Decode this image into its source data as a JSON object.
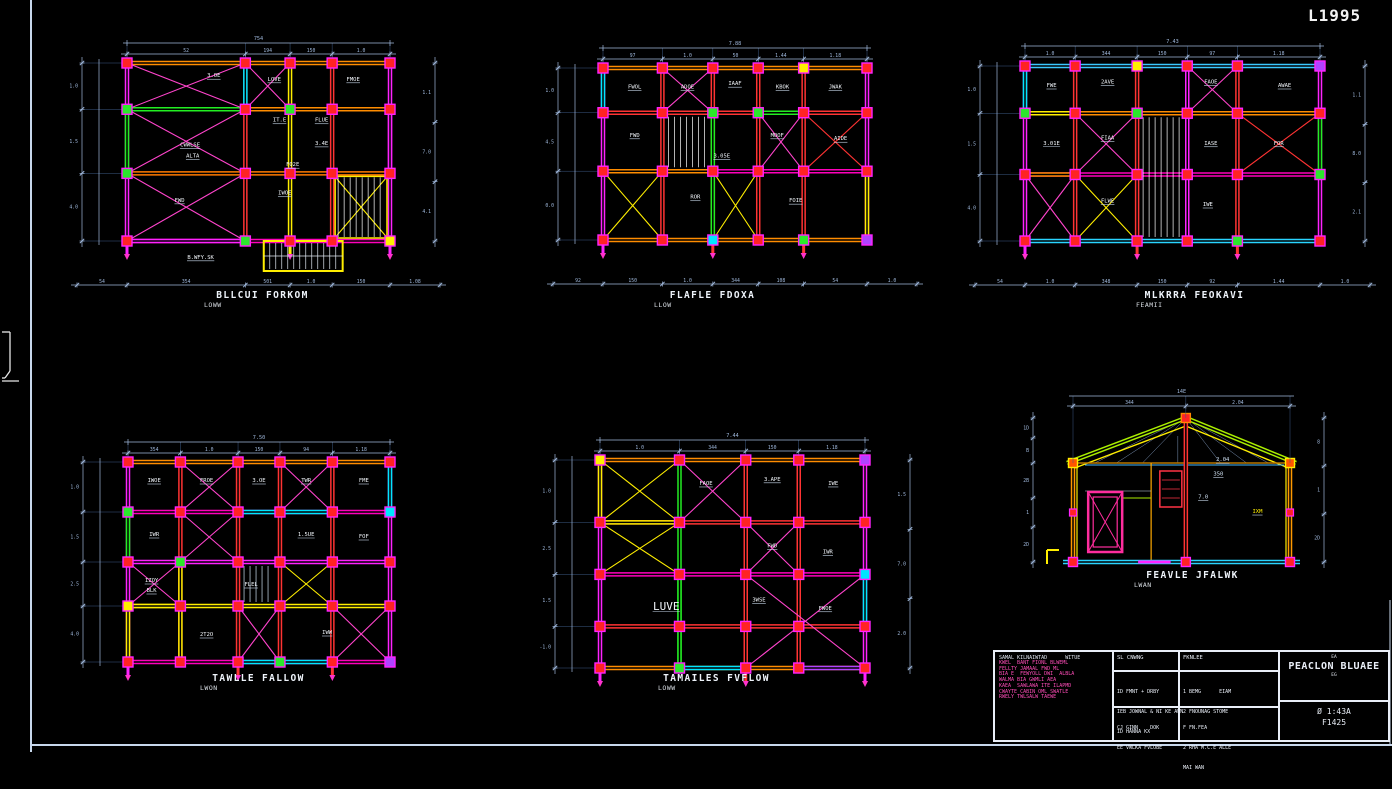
{
  "sheet": {
    "code": "L1995"
  },
  "colors": {
    "background": "#000000",
    "frame": "#c8d8ec",
    "dimension": "#9fb8dc",
    "column_fill": "#ff2323",
    "column_stroke": "#ff22ff",
    "beam_orange": "#ff8c00",
    "beam_red": "#ff3333",
    "beam_magenta": "#ff00bb",
    "accent_green": "#22ee22",
    "accent_yellow": "#ffee00",
    "accent_cyan": "#00e5ff",
    "label_text": "#f2f6fb",
    "notes_pink": "#ff4db8"
  },
  "plans": [
    {
      "cap1": "BLLCUI FORKOM",
      "cap2": "LOWW",
      "x": 127,
      "y": 63,
      "w": 263,
      "h": 178,
      "cols": [
        0,
        0.45,
        0.62,
        0.78,
        1
      ],
      "rows": [
        0,
        0.26,
        0.62,
        1
      ],
      "hc": [
        "#ff8c00",
        "#ff8c00",
        "#ff7a00",
        "#ff00bb"
      ],
      "vc": [
        "#ff22ff",
        "#ff3333",
        "#ffee00",
        "#ff3333",
        "#ff22ff"
      ],
      "segs": [
        {
          "o": "v",
          "i": 0,
          "a": 1,
          "b": 2,
          "c": "#22ee22"
        },
        {
          "o": "h",
          "i": 1,
          "a": 0,
          "b": 1,
          "c": "#22ee22"
        },
        {
          "o": "h",
          "i": 3,
          "a": 0,
          "b": 1,
          "c": "#ff22ff"
        },
        {
          "o": "v",
          "i": 1,
          "a": 0,
          "b": 1,
          "c": "#00e5ff"
        },
        {
          "o": "v",
          "i": 4,
          "a": 1,
          "b": 2,
          "c": "#ff22ff"
        }
      ],
      "braces": [
        {
          "c0": 0,
          "r0": 0,
          "c1": 1,
          "r1": 1,
          "col": "#ff44cc"
        },
        {
          "c0": 0,
          "r0": 1,
          "c1": 1,
          "r1": 2,
          "col": "#ff44cc"
        },
        {
          "c0": 0,
          "r0": 2,
          "c1": 1,
          "r1": 3,
          "col": "#ff44cc"
        },
        {
          "c0": 1,
          "r0": 0,
          "c1": 2,
          "r1": 1,
          "col": "#ff44cc"
        },
        {
          "c0": 3,
          "r0": 2,
          "c1": 4,
          "r1": 3,
          "col": "#ffee00"
        }
      ],
      "stairs": [
        {
          "c0": 3,
          "r0": 2,
          "c1": 4,
          "r1": 3,
          "col": "#ffffff",
          "box": "#ffee00"
        }
      ],
      "ovr": [
        [
          0,
          1,
          "#2be82b"
        ],
        [
          0,
          2,
          "#2be82b"
        ],
        [
          2,
          1,
          "#2be82b"
        ],
        [
          1,
          3,
          "#2be82b"
        ],
        [
          4,
          3,
          "#ffee00"
        ]
      ],
      "labels": [
        [
          "LOVE",
          0.56,
          0.1
        ],
        [
          "FMOE",
          0.86,
          0.1
        ],
        [
          "3.OE",
          0.33,
          0.08
        ],
        [
          "IT.E",
          0.58,
          0.33
        ],
        [
          "FLUE",
          0.74,
          0.33
        ],
        [
          "CWWLSE",
          0.24,
          0.47
        ],
        [
          "ALTA",
          0.25,
          0.53
        ],
        [
          "3.4E",
          0.74,
          0.46
        ],
        [
          "FO2E",
          0.63,
          0.58
        ],
        [
          "IWOE",
          0.6,
          0.74
        ],
        [
          "FWD",
          0.2,
          0.78
        ],
        [
          "B.WFY.SK",
          0.28,
          1.1
        ]
      ],
      "annex": {
        "x0": 0.52,
        "x1": 0.82,
        "h": 30,
        "col": "#ffee00",
        "hatch": true
      },
      "tails": true,
      "total": "754",
      "dt": [
        "52",
        "194",
        "150",
        "1.0"
      ],
      "dl": [
        "1.0",
        "1.5",
        "4.0"
      ],
      "db": [
        "54",
        "354",
        "501",
        "1.0",
        "150",
        "1.08"
      ],
      "dr": [
        "1.1",
        "7.0",
        "4.1"
      ]
    },
    {
      "cap1": "FLAFLE FDOXA",
      "cap2": "LLOW",
      "x": 603,
      "y": 68,
      "w": 264,
      "h": 172,
      "cols": [
        0,
        0.225,
        0.416,
        0.588,
        0.76,
        1
      ],
      "rows": [
        0,
        0.26,
        0.6,
        1
      ],
      "hc": [
        "#ff8c00",
        "#ff3333",
        "#ff00bb",
        "#ff8c00"
      ],
      "vc": [
        "#ff22ff",
        "#ff3333",
        "#ff3333",
        "#ff3333",
        "#ff3333",
        "#ff22ff"
      ],
      "segs": [
        {
          "o": "v",
          "i": 0,
          "a": 0,
          "b": 1,
          "c": "#00e5ff"
        },
        {
          "o": "h",
          "i": 1,
          "a": 3,
          "b": 4,
          "c": "#22ee22"
        },
        {
          "o": "v",
          "i": 2,
          "a": 1,
          "b": 3,
          "c": "#22ee22"
        },
        {
          "o": "v",
          "i": 5,
          "a": 2,
          "b": 3,
          "c": "#ffee00"
        },
        {
          "o": "h",
          "i": 2,
          "a": 0,
          "b": 2,
          "c": "#ff8c00"
        }
      ],
      "braces": [
        {
          "c0": 4,
          "r0": 1,
          "c1": 5,
          "r1": 2,
          "col": "#ff3333"
        },
        {
          "c0": 0,
          "r0": 2,
          "c1": 1,
          "r1": 3,
          "col": "#ffee00"
        },
        {
          "c0": 2,
          "r0": 2,
          "c1": 3,
          "r1": 3,
          "col": "#ffee00"
        },
        {
          "c0": 1,
          "r0": 0,
          "c1": 2,
          "r1": 1,
          "col": "#ff44cc"
        },
        {
          "c0": 3,
          "r0": 1,
          "c1": 4,
          "r1": 2,
          "col": "#ff44cc"
        }
      ],
      "stairs": [
        {
          "c0": 1,
          "r0": 1,
          "c1": 2,
          "r1": 2,
          "col": "#ffffff"
        }
      ],
      "ovr": [
        [
          2,
          1,
          "#2be82b"
        ],
        [
          3,
          1,
          "#2be82b"
        ],
        [
          4,
          0,
          "#ffee00"
        ],
        [
          4,
          3,
          "#2be82b"
        ],
        [
          5,
          3,
          "#b043ff"
        ],
        [
          2,
          3,
          "#00e5ff"
        ]
      ],
      "labels": [
        [
          "FWOL",
          0.12,
          0.12
        ],
        [
          "ADOE",
          0.32,
          0.12
        ],
        [
          "IAAF",
          0.5,
          0.1
        ],
        [
          "KBOK",
          0.68,
          0.12
        ],
        [
          "JWAK",
          0.88,
          0.12
        ],
        [
          "FWD",
          0.12,
          0.4
        ],
        [
          "MOOF",
          0.66,
          0.4
        ],
        [
          "AIDE",
          0.9,
          0.42
        ],
        [
          "3.05E",
          0.45,
          0.52
        ],
        [
          "ROR",
          0.35,
          0.76
        ],
        [
          "FOIE",
          0.73,
          0.78
        ]
      ],
      "tails": true,
      "total": "7.88",
      "dt": [
        "97",
        "1.0",
        "50",
        "1.44",
        "1.18"
      ],
      "dl": [
        "1.0",
        "4.5",
        "0.0"
      ],
      "db": [
        "92",
        "150",
        "1.0",
        "344",
        "108",
        "54",
        "1.0"
      ]
    },
    {
      "cap1": "MLKRRA FEOKAVI",
      "cap2": "FEAMII",
      "x": 1025,
      "y": 66,
      "w": 295,
      "h": 175,
      "cols": [
        0,
        0.17,
        0.38,
        0.55,
        0.72,
        1
      ],
      "rows": [
        0,
        0.27,
        0.62,
        1
      ],
      "hc": [
        "#3ac8ff",
        "#ff8c00",
        "#ff00bb",
        "#2ad4ff"
      ],
      "vc": [
        "#ff22ff",
        "#ff3333",
        "#ff3333",
        "#ff22ff",
        "#ff3333",
        "#ff22ff"
      ],
      "segs": [
        {
          "o": "v",
          "i": 0,
          "a": 0,
          "b": 1,
          "c": "#00e5ff"
        },
        {
          "o": "v",
          "i": 5,
          "a": 1,
          "b": 2,
          "c": "#22ee22"
        },
        {
          "o": "h",
          "i": 1,
          "a": 0,
          "b": 1,
          "c": "#ffee00"
        },
        {
          "o": "v",
          "i": 3,
          "a": 1,
          "b": 3,
          "c": "#ff22ff"
        },
        {
          "o": "h",
          "i": 2,
          "a": 0,
          "b": 1,
          "c": "#ff8c00"
        },
        {
          "o": "h",
          "i": 1,
          "a": 3,
          "b": 5,
          "c": "#ff8c00"
        }
      ],
      "braces": [
        {
          "c0": 3,
          "r0": 0,
          "c1": 4,
          "r1": 1,
          "col": "#ff44cc"
        },
        {
          "c0": 4,
          "r0": 1,
          "c1": 5,
          "r1": 2,
          "col": "#ff3333"
        },
        {
          "c0": 1,
          "r0": 1,
          "c1": 2,
          "r1": 2,
          "col": "#ff44cc"
        },
        {
          "c0": 0,
          "r0": 2,
          "c1": 1,
          "r1": 3,
          "col": "#ff44cc"
        },
        {
          "c0": 1,
          "r0": 2,
          "c1": 2,
          "r1": 3,
          "col": "#ffee00"
        }
      ],
      "stairs": [
        {
          "c0": 2,
          "r0": 1,
          "c1": 3,
          "r1": 3,
          "col": "#ffffff"
        }
      ],
      "ovr": [
        [
          0,
          1,
          "#2be82b"
        ],
        [
          5,
          2,
          "#2be82b"
        ],
        [
          2,
          0,
          "#ffee00"
        ],
        [
          5,
          0,
          "#b043ff"
        ],
        [
          2,
          1,
          "#2be82b"
        ],
        [
          4,
          3,
          "#2be82b"
        ]
      ],
      "labels": [
        [
          "FWE",
          0.09,
          0.12
        ],
        [
          "2AVE",
          0.28,
          0.1
        ],
        [
          "FAOE",
          0.63,
          0.1
        ],
        [
          "AWAE",
          0.88,
          0.12
        ],
        [
          "3.01E",
          0.09,
          0.45
        ],
        [
          "FIAA",
          0.28,
          0.42
        ],
        [
          "IASE",
          0.63,
          0.45
        ],
        [
          "FOR",
          0.86,
          0.45
        ],
        [
          "FLWE",
          0.28,
          0.78
        ],
        [
          "IWE",
          0.62,
          0.8
        ]
      ],
      "tails": true,
      "total": "7.43",
      "dt": [
        "1.0",
        "344",
        "150",
        "97",
        "1.18"
      ],
      "dl": [
        "1.0",
        "1.5",
        "4.0"
      ],
      "db": [
        "54",
        "1.0",
        "348",
        "150",
        "92",
        "1.44",
        "1.0"
      ],
      "dr": [
        "1.1",
        "8.0",
        "2.1"
      ]
    },
    {
      "cap1": "TAWLLE FALLOW",
      "cap2": "LWON",
      "x": 128,
      "y": 462,
      "w": 262,
      "h": 200,
      "cols": [
        0,
        0.2,
        0.42,
        0.58,
        0.78,
        1
      ],
      "rows": [
        0,
        0.25,
        0.5,
        0.72,
        1
      ],
      "hc": [
        "#ff8c00",
        "#ff00bb",
        "#ff22ff",
        "#ffee00",
        "#ff00bb"
      ],
      "vc": [
        "#ff22ff",
        "#ff3333",
        "#ff3333",
        "#ff3333",
        "#ff3333",
        "#ff22ff"
      ],
      "segs": [
        {
          "o": "v",
          "i": 0,
          "a": 1,
          "b": 2,
          "c": "#22ee22"
        },
        {
          "o": "h",
          "i": 1,
          "a": 2,
          "b": 4,
          "c": "#00e5ff"
        },
        {
          "o": "v",
          "i": 5,
          "a": 0,
          "b": 1,
          "c": "#00e5ff"
        },
        {
          "o": "h",
          "i": 3,
          "a": 0,
          "b": 1,
          "c": "#ffee00"
        },
        {
          "o": "v",
          "i": 1,
          "a": 2,
          "b": 4,
          "c": "#ffee00"
        },
        {
          "o": "h",
          "i": 4,
          "a": 2,
          "b": 4,
          "c": "#00e5ff"
        },
        {
          "o": "v",
          "i": 0,
          "a": 3,
          "b": 4,
          "c": "#ffee00"
        }
      ],
      "braces": [
        {
          "c0": 1,
          "r0": 0,
          "c1": 2,
          "r1": 1,
          "col": "#ff44cc"
        },
        {
          "c0": 3,
          "r0": 0,
          "c1": 4,
          "r1": 1,
          "col": "#ff44cc"
        },
        {
          "c0": 1,
          "r0": 1,
          "c1": 2,
          "r1": 2,
          "col": "#ff44cc"
        },
        {
          "c0": 3,
          "r0": 2,
          "c1": 4,
          "r1": 3,
          "col": "#ffee00"
        },
        {
          "c0": 2,
          "r0": 3,
          "c1": 3,
          "r1": 4,
          "col": "#ff44cc"
        },
        {
          "c0": 0,
          "r0": 2,
          "c1": 1,
          "r1": 3,
          "col": "#ff44cc"
        },
        {
          "c0": 4,
          "r0": 3,
          "c1": 5,
          "r1": 4,
          "col": "#ff44cc"
        }
      ],
      "stairs": [
        {
          "c0": 2,
          "r0": 2,
          "c1": 3,
          "r1": 3,
          "col": "#cfe0f2"
        }
      ],
      "ovr": [
        [
          0,
          1,
          "#2be82b"
        ],
        [
          0,
          3,
          "#ffee00"
        ],
        [
          5,
          1,
          "#00e5ff"
        ],
        [
          3,
          4,
          "#2be82b"
        ],
        [
          5,
          4,
          "#b043ff"
        ],
        [
          1,
          2,
          "#2be82b"
        ]
      ],
      "labels": [
        [
          "IWOE",
          0.1,
          0.1
        ],
        [
          "FROE",
          0.3,
          0.1
        ],
        [
          "3.OE",
          0.5,
          0.1
        ],
        [
          "TWR",
          0.68,
          0.1
        ],
        [
          "FME",
          0.9,
          0.1
        ],
        [
          "IWR",
          0.1,
          0.37
        ],
        [
          "1.5UE",
          0.68,
          0.37
        ],
        [
          "FOF",
          0.9,
          0.38
        ],
        [
          "IZOY",
          0.09,
          0.6
        ],
        [
          "BLK",
          0.09,
          0.65
        ],
        [
          "FLEL",
          0.47,
          0.62
        ],
        [
          "2T2O",
          0.3,
          0.87
        ],
        [
          "IWW",
          0.76,
          0.86
        ]
      ],
      "tails": true,
      "total": "7.50",
      "dt": [
        "354",
        "1.0",
        "150",
        "94",
        "1.18"
      ],
      "dl": [
        "1.0",
        "1.5",
        "2.5",
        "4.0"
      ]
    },
    {
      "cap1": "TAMAILES FVFLOW",
      "cap2": "LOWW",
      "x": 600,
      "y": 460,
      "w": 265,
      "h": 208,
      "cols": [
        0,
        0.3,
        0.55,
        0.75,
        1
      ],
      "rows": [
        0,
        0.3,
        0.55,
        0.8,
        1
      ],
      "hc": [
        "#ff8c00",
        "#ff3333",
        "#ff00bb",
        "#ff3333",
        "#ff8c00"
      ],
      "vc": [
        "#ff22ff",
        "#22ee22",
        "#ff3333",
        "#ff3333",
        "#ff22ff"
      ],
      "segs": [
        {
          "o": "v",
          "i": 0,
          "a": 0,
          "b": 1,
          "c": "#ffee00"
        },
        {
          "o": "h",
          "i": 1,
          "a": 0,
          "b": 1,
          "c": "#ffee00"
        },
        {
          "o": "v",
          "i": 4,
          "a": 2,
          "b": 3,
          "c": "#00e5ff"
        },
        {
          "o": "h",
          "i": 4,
          "a": 1,
          "b": 2,
          "c": "#00e5ff"
        },
        {
          "o": "v",
          "i": 1,
          "a": 2,
          "b": 4,
          "c": "#22ee22"
        },
        {
          "o": "h",
          "i": 4,
          "a": 3,
          "b": 4,
          "c": "#b043ff"
        }
      ],
      "braces": [
        {
          "c0": 0,
          "r0": 0,
          "c1": 1,
          "r1": 1,
          "col": "#ffee00"
        },
        {
          "c0": 0,
          "r0": 1,
          "c1": 1,
          "r1": 2,
          "col": "#ffee00"
        },
        {
          "c0": 2,
          "r0": 1,
          "c1": 3,
          "r1": 2,
          "col": "#ff44cc"
        },
        {
          "c0": 2,
          "r0": 2,
          "c1": 4,
          "r1": 4,
          "col": "#ff44cc"
        },
        {
          "c0": 1,
          "r0": 0,
          "c1": 2,
          "r1": 1,
          "col": "#ff44cc"
        }
      ],
      "ovr": [
        [
          0,
          0,
          "#ffee00"
        ],
        [
          4,
          2,
          "#00e5ff"
        ],
        [
          1,
          4,
          "#2be82b"
        ],
        [
          4,
          0,
          "#b043ff"
        ]
      ],
      "labels": [
        [
          "FAOE",
          0.4,
          0.12
        ],
        [
          "3.APE",
          0.65,
          0.1
        ],
        [
          "IWE",
          0.88,
          0.12
        ],
        [
          "FWD",
          0.65,
          0.42
        ],
        [
          "IWR",
          0.86,
          0.45
        ],
        [
          "LUVE",
          0.25,
          0.72,
          "big"
        ],
        [
          "3WSE",
          0.6,
          0.68
        ],
        [
          "FWOE",
          0.85,
          0.72
        ]
      ],
      "tails": true,
      "total": "7.44",
      "dt": [
        "1.0",
        "344",
        "150",
        "1.18"
      ],
      "dl": [
        "1.0",
        "2.5",
        "1.5",
        "-1.0"
      ],
      "dr": [
        "1.5",
        "7.0",
        "2.0"
      ]
    },
    {
      "type": "sec",
      "cap1": "FEAVLE JFALWK",
      "cap2": "LWAN",
      "x": 1073,
      "y": 418,
      "w": 217,
      "h": 144,
      "eave": 45,
      "total": "14E",
      "dt": [
        "344",
        "2.04"
      ],
      "dl": [
        "1D",
        "B",
        "2B",
        "1",
        "2D"
      ],
      "dr": [
        "8",
        "1",
        "2D"
      ],
      "labels": [
        [
          "2.04",
          0.69,
          0.3
        ],
        [
          "350",
          0.67,
          0.4
        ],
        [
          "7.0",
          0.6,
          0.56
        ],
        [
          "IXM",
          0.85,
          0.66,
          "y"
        ]
      ]
    }
  ],
  "title_block": {
    "notes_header": "SAMAL KILNAIWTAD      WITUE",
    "notes": [
      "KWEL  BANT FIONL BLWEML",
      "FELLTY JAMAAL FWD ML",
      "BIA E  FEWYOLL DWI  ALBLA",
      "WALMA BIA GWMLI AEA",
      "KAEA  SAWLAWA ITE ILAPMD",
      "CWAYTE CABIN OML SWATLE",
      "RWELY TWLSALW TAEWE"
    ],
    "col2_header": "SL CNWNG",
    "col2_rows1": [
      "ID FMNT + DRBY",
      "IEB JOWNAL & NI KE AWN",
      "ID HANNA KX"
    ],
    "col2_rows2": [
      "CJ GINN    DOK",
      "EE VWLKA FVLOBE"
    ],
    "col3_header": "FKNLEE",
    "col3_rows1": [
      "1 BEMG      EIAM",
      "2 FNOUNAG STOME"
    ],
    "col3_rows2": [
      "F FN.FEA",
      "2 RHA M.C.E ALLE",
      "MAI WAN"
    ],
    "right_small_top": "EA",
    "right_title": "PEACLON BLUAEE",
    "right_small_sub": "EG",
    "right_scale": "Ø 1:43A",
    "right_number": "F1425"
  }
}
